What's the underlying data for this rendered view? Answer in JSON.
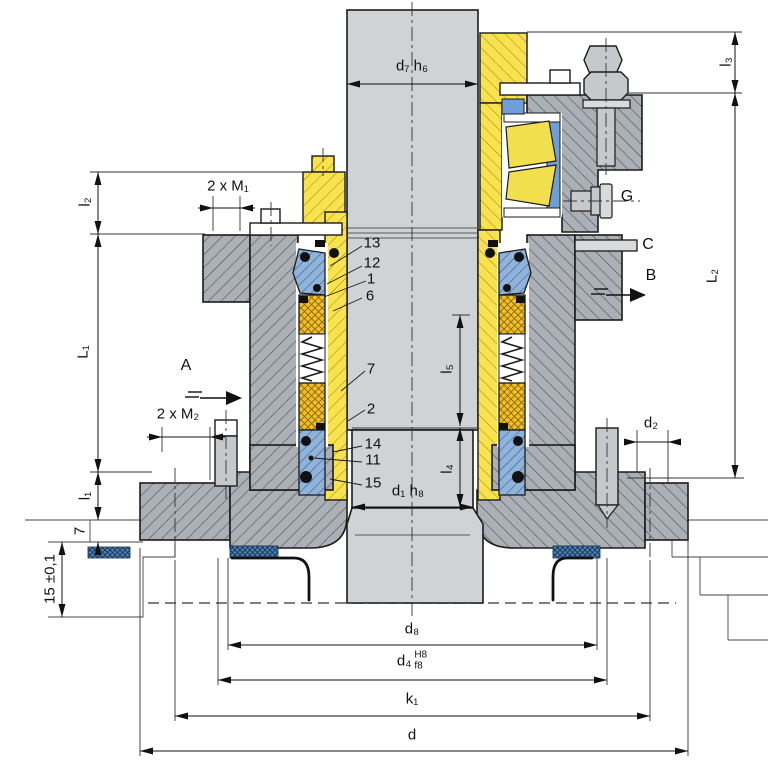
{
  "dims": {
    "d7": "d₇ h₆",
    "l3": "l₃",
    "l2": "l₂",
    "m1": "2 x M₁",
    "L1": "L₁",
    "m2": "2 x M₂",
    "l5": "l₅",
    "l4": "l₄",
    "d1": "d₁ h₈",
    "d2": "d₂",
    "L2": "L₂",
    "l1": "l₁",
    "lip": "7",
    "tol": "15 ±0,1",
    "d8": "d₈",
    "d4_base": "d₄",
    "d4_sup": "H8",
    "d4_sub": "f8",
    "k1": "k₁",
    "d": "d"
  },
  "callouts": {
    "c13": "13",
    "c12": "12",
    "c1": "1",
    "c6": "6",
    "c7": "7",
    "c2": "2",
    "c14": "14",
    "c11": "11",
    "c15": "15"
  },
  "ports": {
    "A": "A",
    "B": "B",
    "C": "C",
    "G": "G"
  },
  "colors": {
    "housing_gray": "#aab0b6",
    "sleeve_yellow": "#f8e34f",
    "seal_face_gold": "#f1bf27",
    "component_blue": "#8fb3da",
    "bearing_cage_blue": "#6f9fd4",
    "gasket_blue": "#4d80b4",
    "shaft_gray": "#d0d3d5",
    "line_ink": "#1b1b1b"
  }
}
